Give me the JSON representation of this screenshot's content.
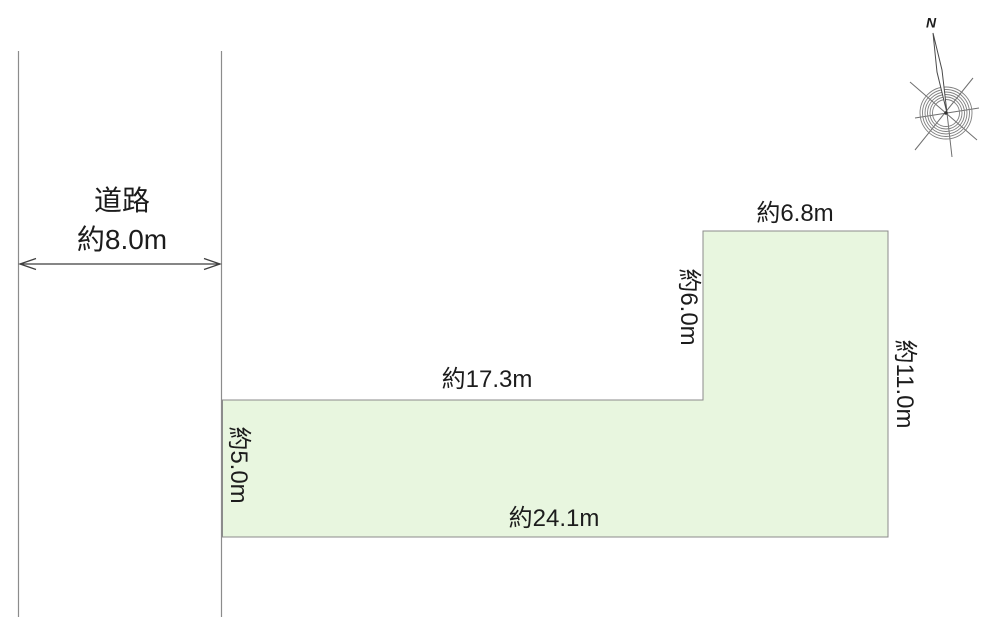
{
  "colors": {
    "background": "#ffffff",
    "plot_fill": "#e8f6df",
    "plot_border": "#8b8b8b",
    "road_line": "#8c8c8c",
    "arrow": "#3f3f3f",
    "text": "#1c1c1c"
  },
  "road": {
    "name": "道路",
    "width": "約8.0m"
  },
  "plot": {
    "dim_top_upper": "約6.8m",
    "dim_left_upper": "約6.0m",
    "dim_right": "約11.0m",
    "dim_top_lower": "約17.3m",
    "dim_left_lower": "約5.0m",
    "dim_bottom": "約24.1m"
  },
  "compass": {
    "north": "N"
  }
}
